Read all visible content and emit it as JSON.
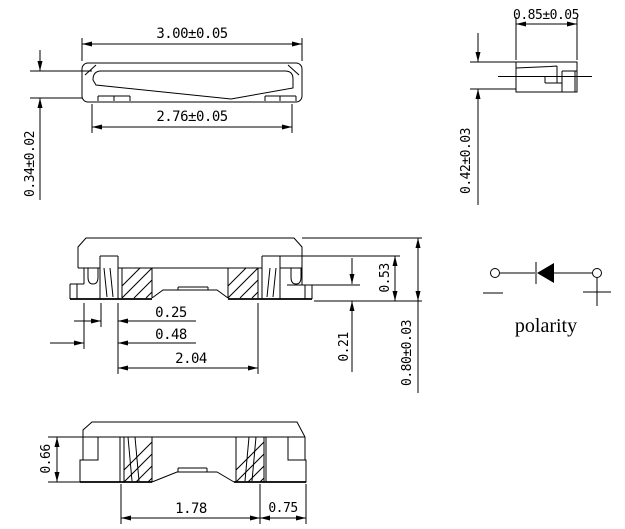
{
  "dims": {
    "front_width": "3.00±0.05",
    "front_inner_width": "2.76±0.05",
    "front_height": "0.34±0.02",
    "side_width": "0.85±0.05",
    "side_height": "0.42±0.03",
    "section_inner_step": "0.25",
    "section_lead_width": "0.48",
    "section_span": "2.04",
    "section_step_height": "0.53",
    "section_foot_height": "0.21",
    "section_total_height": "0.80±0.03",
    "bottom_terminal_height": "0.66",
    "bottom_pad_span": "1.78",
    "bottom_pad_width": "0.75"
  },
  "polarity": {
    "label": "polarity",
    "cathode_mark": "−",
    "anode_mark": "+"
  },
  "colors": {
    "line": "#000000",
    "background": "#ffffff"
  }
}
